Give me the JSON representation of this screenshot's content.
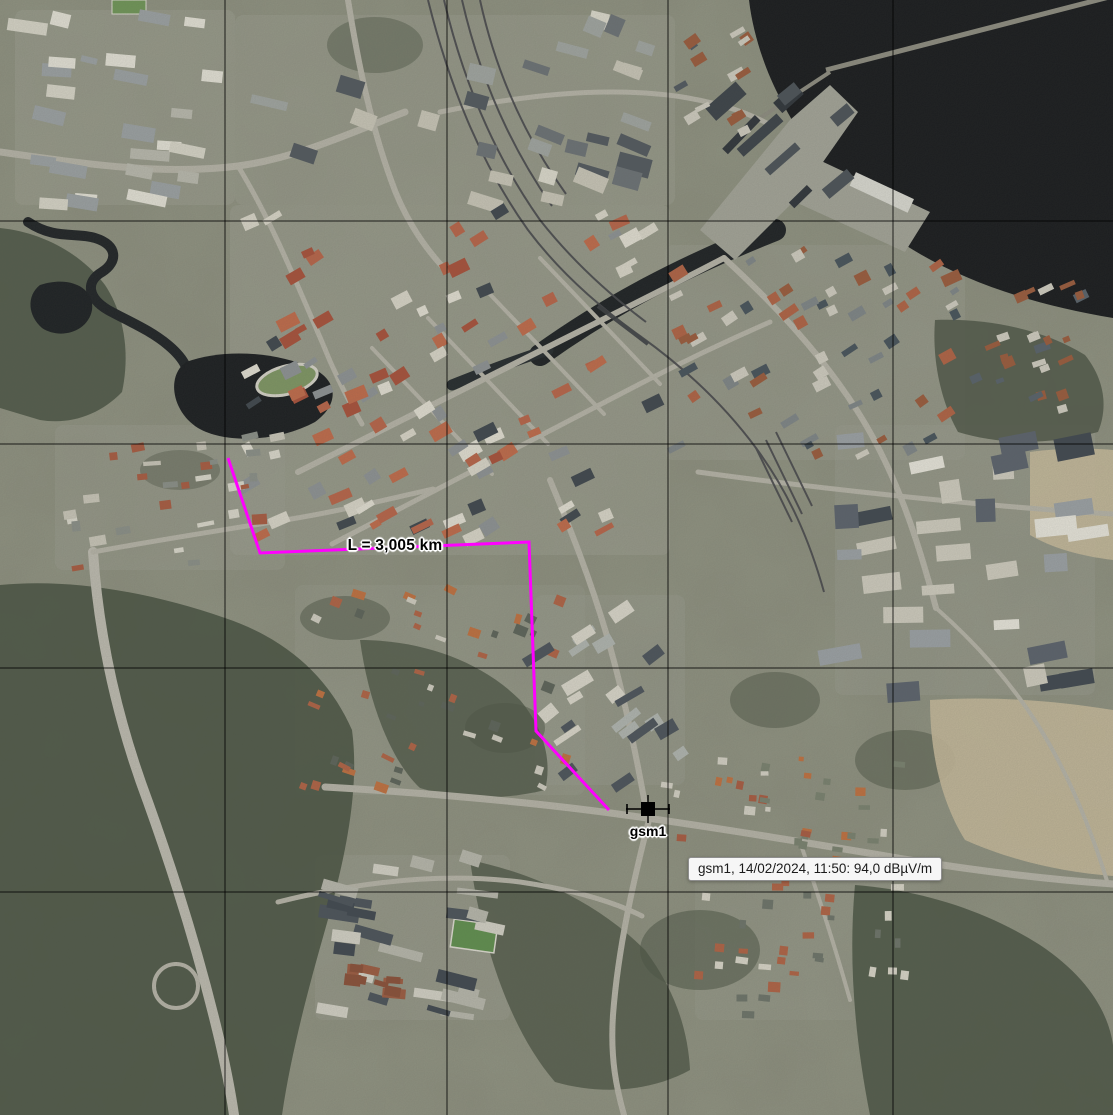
{
  "map": {
    "width": 1113,
    "height": 1115,
    "grid": {
      "color": "#000000",
      "opacity": 0.8,
      "vertical_x": [
        225,
        447,
        668,
        893
      ],
      "horizontal_y": [
        221,
        444,
        668,
        892
      ]
    }
  },
  "measurement": {
    "label": "L = 3,005 km",
    "color": "#ff00ff",
    "line_width": 3,
    "label_pos": {
      "x": 395,
      "y": 546
    },
    "points": [
      [
        228,
        458
      ],
      [
        260,
        553
      ],
      [
        529,
        542
      ],
      [
        536,
        731
      ],
      [
        609,
        810
      ]
    ]
  },
  "site": {
    "name": "gsm1",
    "label": "gsm1",
    "color": "#000000",
    "x": 648,
    "y": 809,
    "label_pos": {
      "x": 648,
      "y": 831
    }
  },
  "tooltip": {
    "text": "gsm1, 14/02/2024, 11:50: 94,0 dBµV/m",
    "x": 688,
    "y": 857,
    "background": "#f6f6f6",
    "border_color": "#8e8e8e"
  }
}
